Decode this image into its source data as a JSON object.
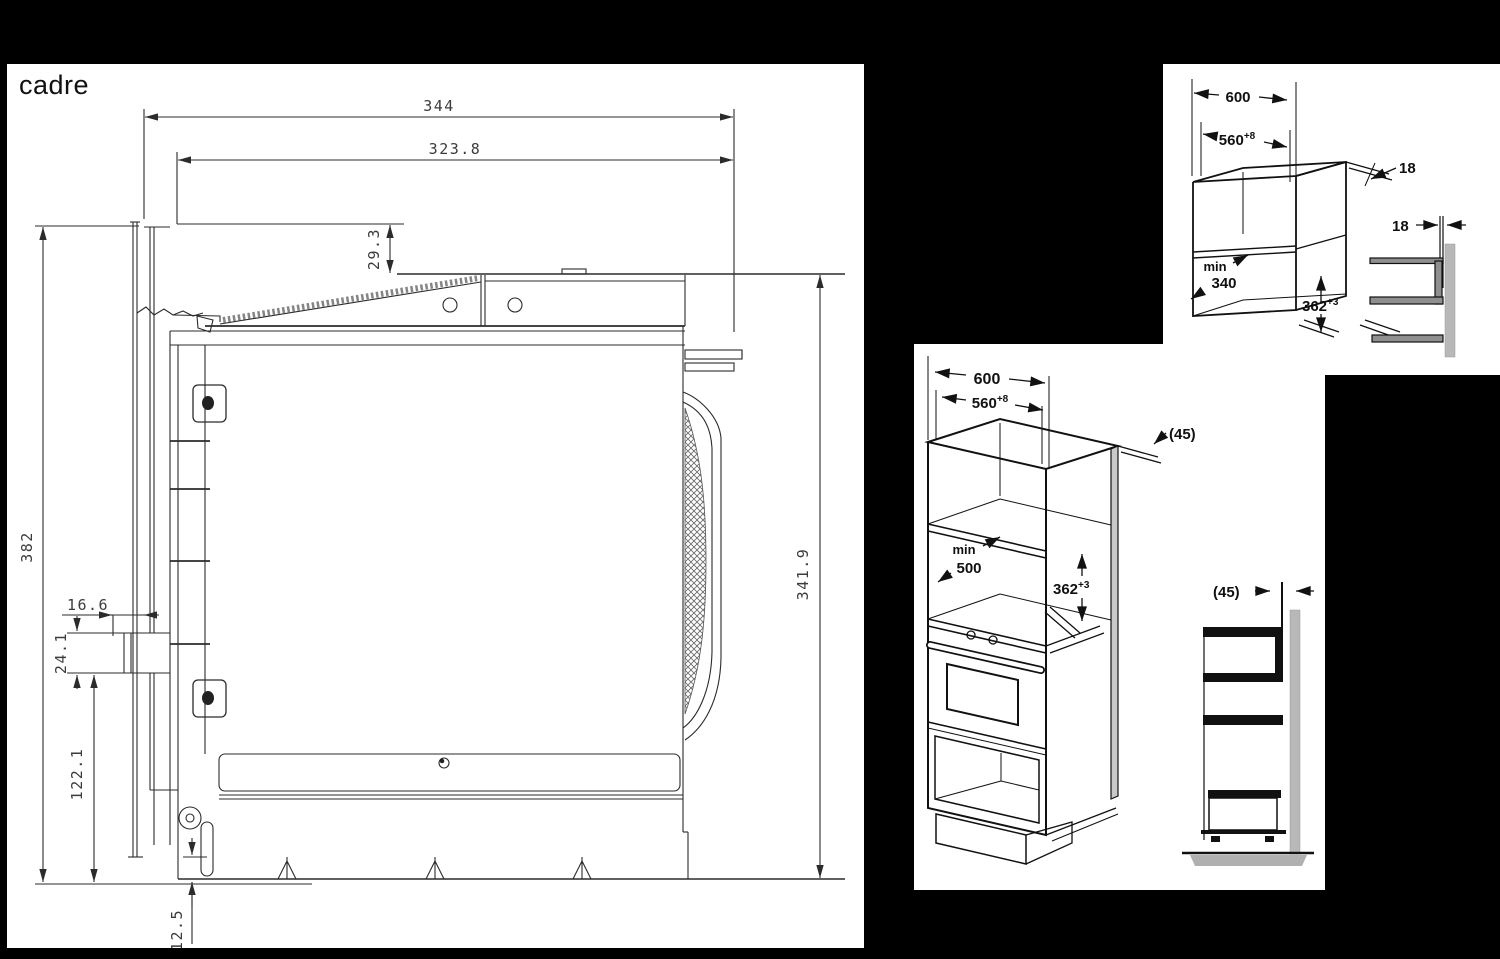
{
  "frame": {
    "title": "cadre",
    "dim_width_overall": "344",
    "dim_width_body": "323.8",
    "dim_bracket_drop": "29.3",
    "dim_height_overall": "382",
    "dim_height_body": "341.9",
    "dim_clip_offset": "16.6",
    "dim_clip_height": "24.1",
    "dim_lower_section": "122.1",
    "dim_base_lip": "12.5"
  },
  "wall_cabinet": {
    "dim_width": "600",
    "dim_inner_width": "560",
    "dim_inner_width_sup": "+8",
    "dim_panel_top": "18",
    "dim_panel_side": "18",
    "depth_min_label": "min",
    "depth_min_value": "340",
    "dim_niche_height": "362",
    "dim_niche_height_sup": "+3"
  },
  "tall_cabinet": {
    "dim_width": "600",
    "dim_inner_width": "560",
    "dim_inner_width_sup": "+8",
    "dim_top_gap": "(45)",
    "depth_min_label": "min",
    "depth_min_value": "500",
    "dim_niche_height": "362",
    "dim_niche_height_sup": "+3",
    "dim_wall_gap": "(45)"
  }
}
